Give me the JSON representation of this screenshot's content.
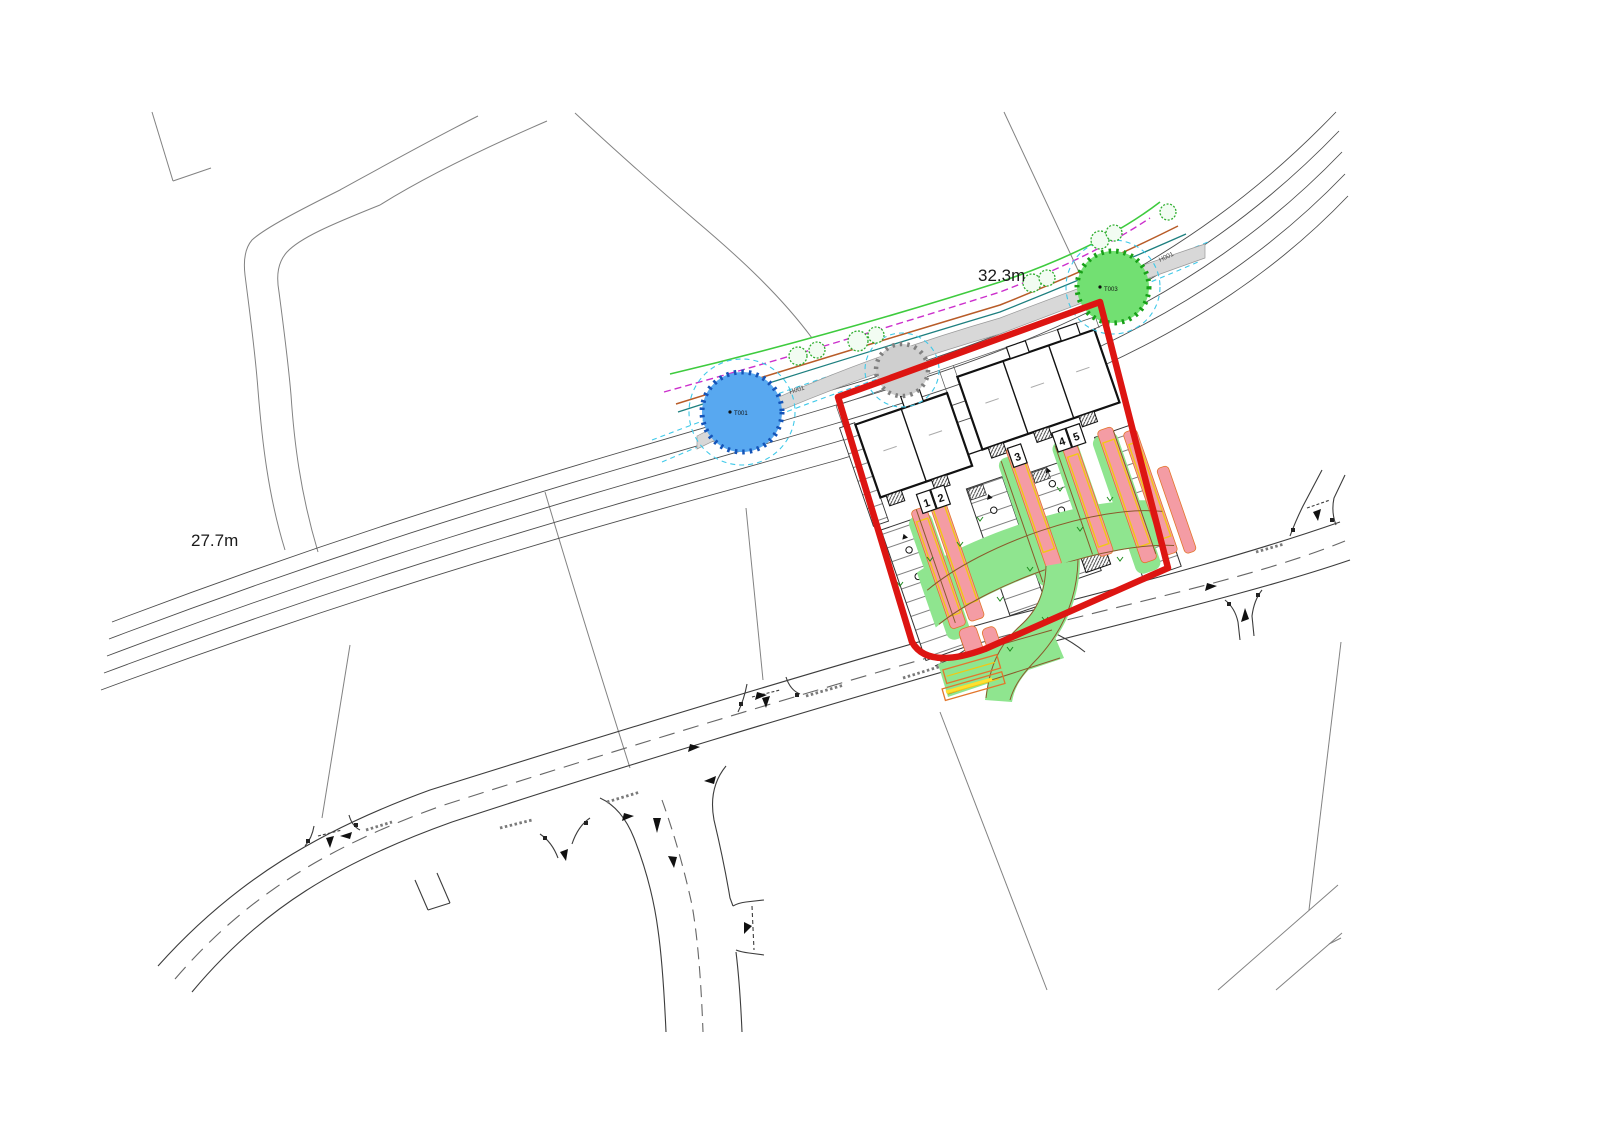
{
  "drawing": {
    "dim_label_upper": "32.3m",
    "dim_label_lower": "27.7m",
    "hedge_label_left": "H001",
    "hedge_label_right": "H001",
    "tree_label_blue": "T001",
    "tree_label_green": "T003",
    "plot_numbers": [
      "1",
      "2",
      "3",
      "4",
      "5"
    ],
    "colors": {
      "site_boundary": "#dd1512",
      "swept_path_body": "#8fe58f",
      "swept_path_overhang": "#f49ca4",
      "vehicle_outline": "#f2c714",
      "vehicle_outline_orange": "#e2762c",
      "tree_t001": "#58a8f0",
      "tree_t003": "#72e072",
      "tree_unsurveyed": "#cfcfcf",
      "hedge_band": "#d8d8d8",
      "hedgerow_green": "#3ecb3e",
      "hedgerow_magenta": "#cc2fcc",
      "hedgerow_brown": "#b85c28",
      "hedgerow_teal": "#1d7f7f",
      "canopy_cyan": "#3fc9e9"
    }
  }
}
